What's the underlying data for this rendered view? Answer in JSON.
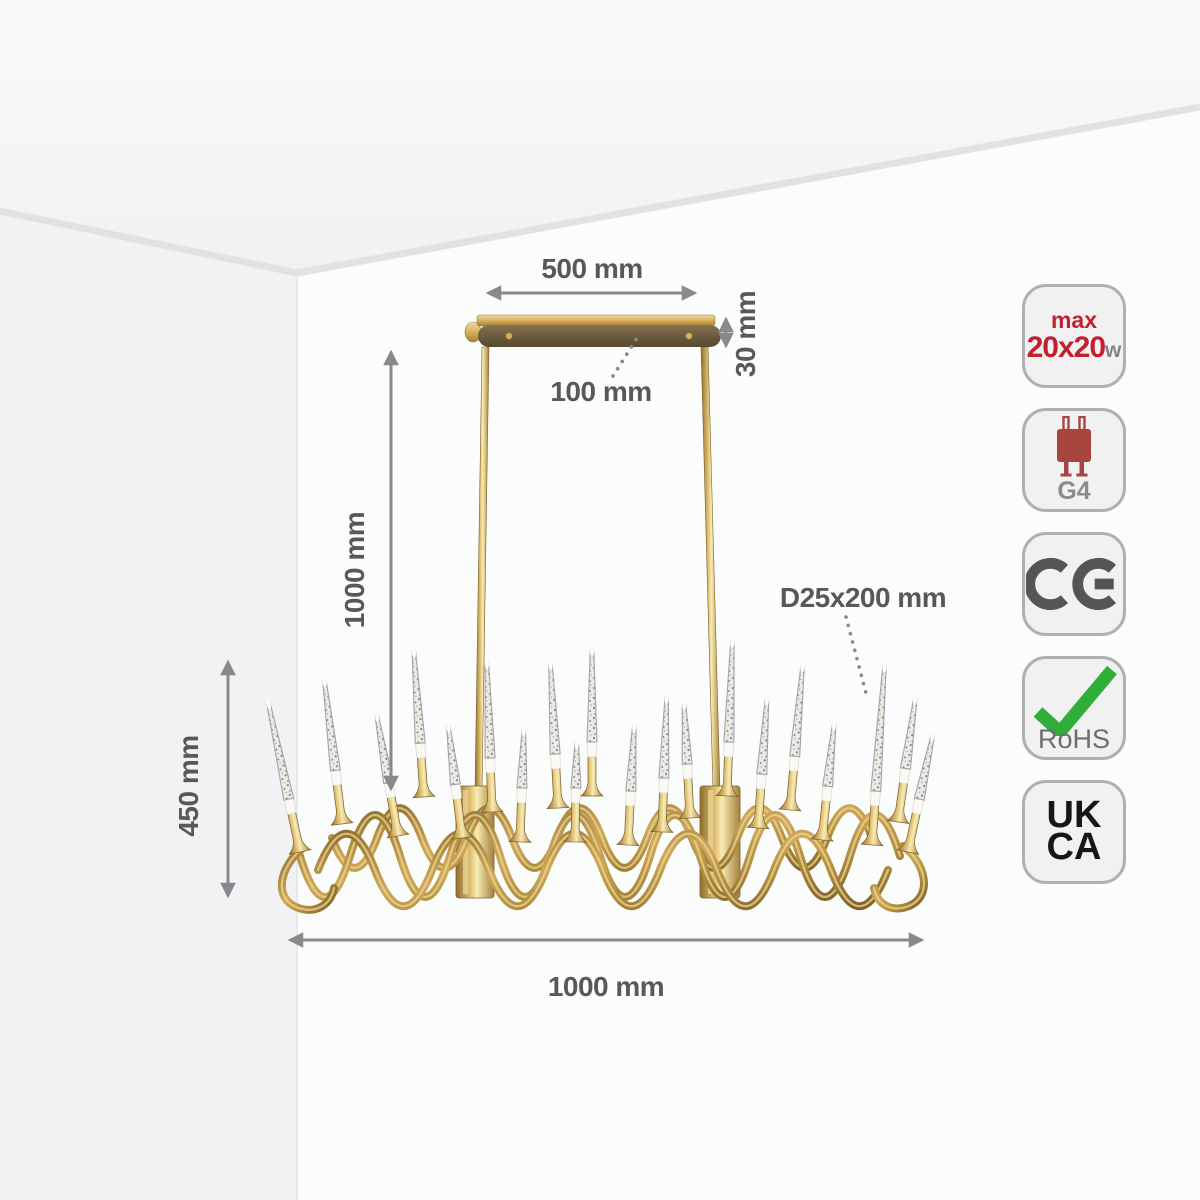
{
  "dimensions": {
    "canopy_width": "500 mm",
    "canopy_thickness": "30 mm",
    "canopy_depth": "100 mm",
    "suspension_height": "1000 mm",
    "fixture_height": "450 mm",
    "fixture_width": "1000 mm",
    "bulb_tube_size": "D25x200 mm"
  },
  "badges": {
    "max_power_prefix": "max",
    "max_power_value": "20x20",
    "max_power_unit": "w",
    "lamp_base": "G4",
    "ce_mark": "CE",
    "rohs": "RoHS",
    "ukca_line1": "UK",
    "ukca_line2": "CA"
  },
  "colors": {
    "accent_red": "#c41e2f",
    "gold": "#c79a46",
    "check_green": "#2fae39",
    "dimension_gray": "#57585a",
    "arrow_gray": "#87898c"
  }
}
